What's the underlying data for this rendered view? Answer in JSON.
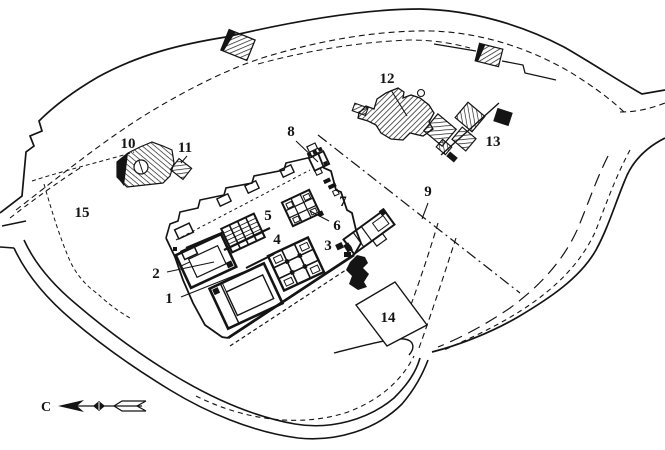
{
  "figure": {
    "type": "archaeological-site-plan",
    "background_color": "#ffffff",
    "ink_color": "#141414"
  },
  "compass": {
    "label": "С",
    "icon": "north-arrow-icon"
  },
  "labels": [
    {
      "text": "1",
      "x": 169,
      "y": 303,
      "leader": [
        181,
        297,
        251,
        269
      ]
    },
    {
      "text": "2",
      "x": 156,
      "y": 278,
      "leader": [
        167,
        272,
        214,
        262
      ]
    },
    {
      "text": "3",
      "x": 328,
      "y": 250,
      "leader": null
    },
    {
      "text": "4",
      "x": 277,
      "y": 244,
      "leader": null
    },
    {
      "text": "5",
      "x": 268,
      "y": 220,
      "leader": null
    },
    {
      "text": "6",
      "x": 337,
      "y": 230,
      "leader": [
        329,
        221,
        310,
        211
      ]
    },
    {
      "text": "7",
      "x": 343,
      "y": 206,
      "leader": null
    },
    {
      "text": "8",
      "x": 291,
      "y": 136,
      "leader": [
        296,
        141,
        318,
        162
      ]
    },
    {
      "text": "9",
      "x": 428,
      "y": 196,
      "leader": [
        428,
        203,
        422,
        219
      ]
    },
    {
      "text": "10",
      "x": 128,
      "y": 148,
      "leader": null
    },
    {
      "text": "11",
      "x": 185,
      "y": 152,
      "leader": [
        187,
        156,
        181,
        163
      ]
    },
    {
      "text": "12",
      "x": 387,
      "y": 83,
      "leader": [
        391,
        90,
        407,
        116
      ]
    },
    {
      "text": "13",
      "x": 493,
      "y": 146,
      "leader": null
    },
    {
      "text": "14",
      "x": 388,
      "y": 322,
      "leader": null
    },
    {
      "text": "15",
      "x": 82,
      "y": 217,
      "leader": null
    }
  ]
}
